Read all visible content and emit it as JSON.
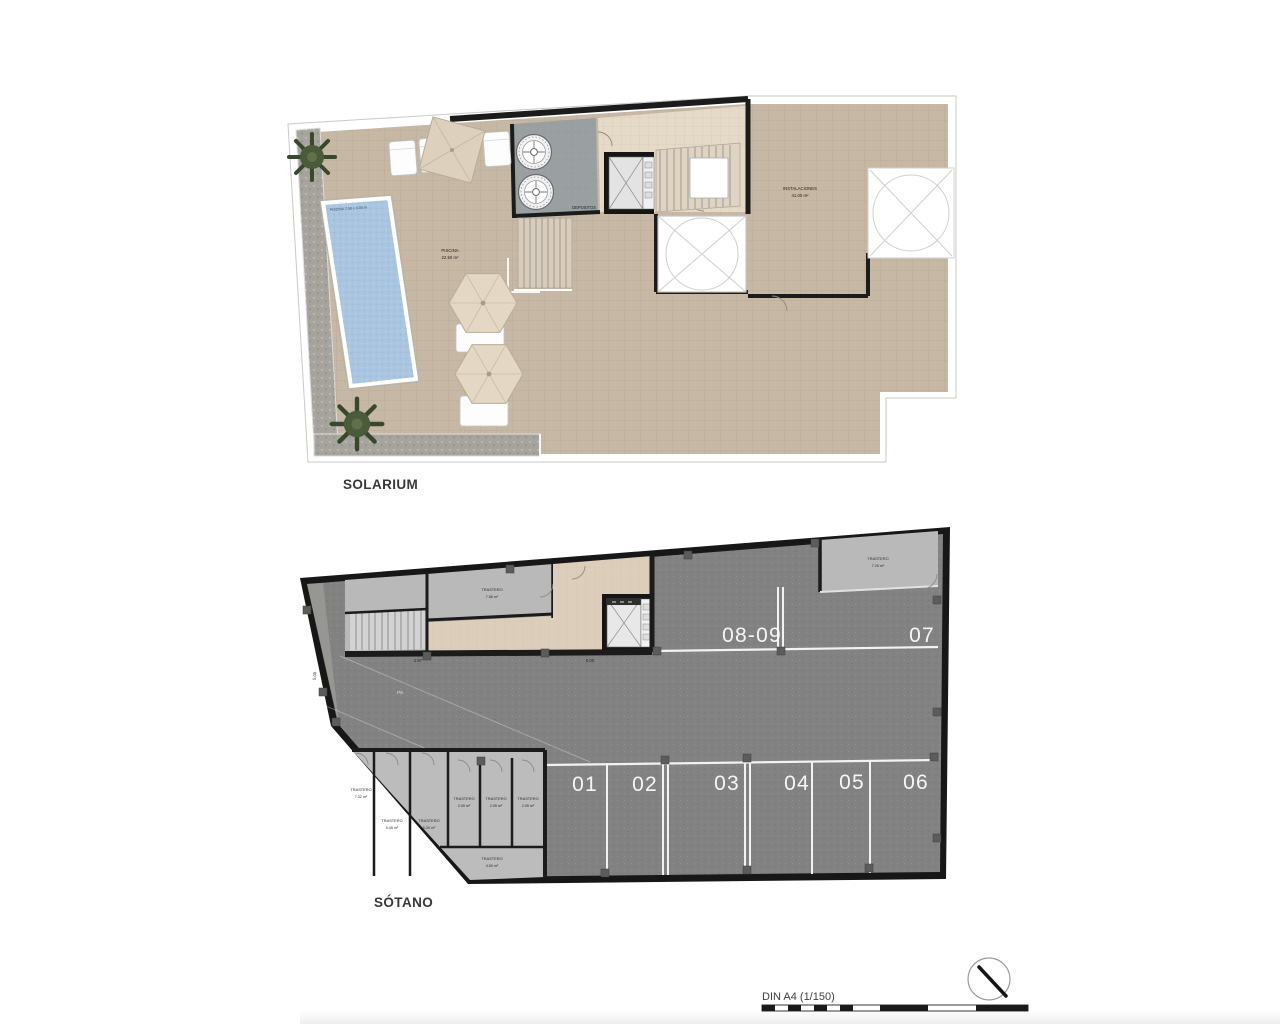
{
  "colors": {
    "terrace": "#c6b8a5",
    "deck": "#a6a49c",
    "pool": "#a9c5df",
    "lobby_beige": "#e5d9c7",
    "plant_room": "#9aa0a2",
    "wall": "#1b1b1b",
    "asphalt": "#828282",
    "storage_gray": "#b9b9b9",
    "parking_line": "#f2f2f2",
    "page_background": "#ffffff"
  },
  "solarium": {
    "title": "SOLARIUM",
    "pool": {
      "dims_label": "PISCINA 7.50 x 3.00 m",
      "name": "PISCINA",
      "area": "22.50 m²"
    },
    "installations": {
      "name": "INSTALACIONES",
      "area": "41.00 m²"
    },
    "deposits_label": "DEPOSITOS"
  },
  "sotano": {
    "title": "SÓTANO",
    "parking_top": [
      {
        "label": "08-09"
      },
      {
        "label": "07"
      }
    ],
    "parking_bottom": [
      {
        "label": "01"
      },
      {
        "label": "02"
      },
      {
        "label": "03"
      },
      {
        "label": "04"
      },
      {
        "label": "05"
      },
      {
        "label": "06"
      }
    ],
    "trasteros": [
      {
        "name": "TRASTERO",
        "area": "7.56 m²"
      },
      {
        "name": "TRASTERO",
        "area": "7.25 m²"
      },
      {
        "name": "TRASTERO",
        "area": "7.32 m²"
      },
      {
        "name": "TRASTERO",
        "area": "5.45 m²"
      },
      {
        "name": "TRASTERO",
        "area": "5.30 m²"
      },
      {
        "name": "TRASTERO",
        "area": "3.95 m²"
      },
      {
        "name": "TRASTERO",
        "area": "2.95 m²"
      },
      {
        "name": "TRASTERO",
        "area": "2.95 m²"
      },
      {
        "name": "TRASTERO",
        "area": "4.50 m²"
      }
    ],
    "dims": {
      "level_left": "5.00",
      "dim_a": "2.97",
      "dim_b": "0.00",
      "ramp": "P6"
    }
  },
  "footer": {
    "scale_label": "DIN A4 (1/150)"
  }
}
